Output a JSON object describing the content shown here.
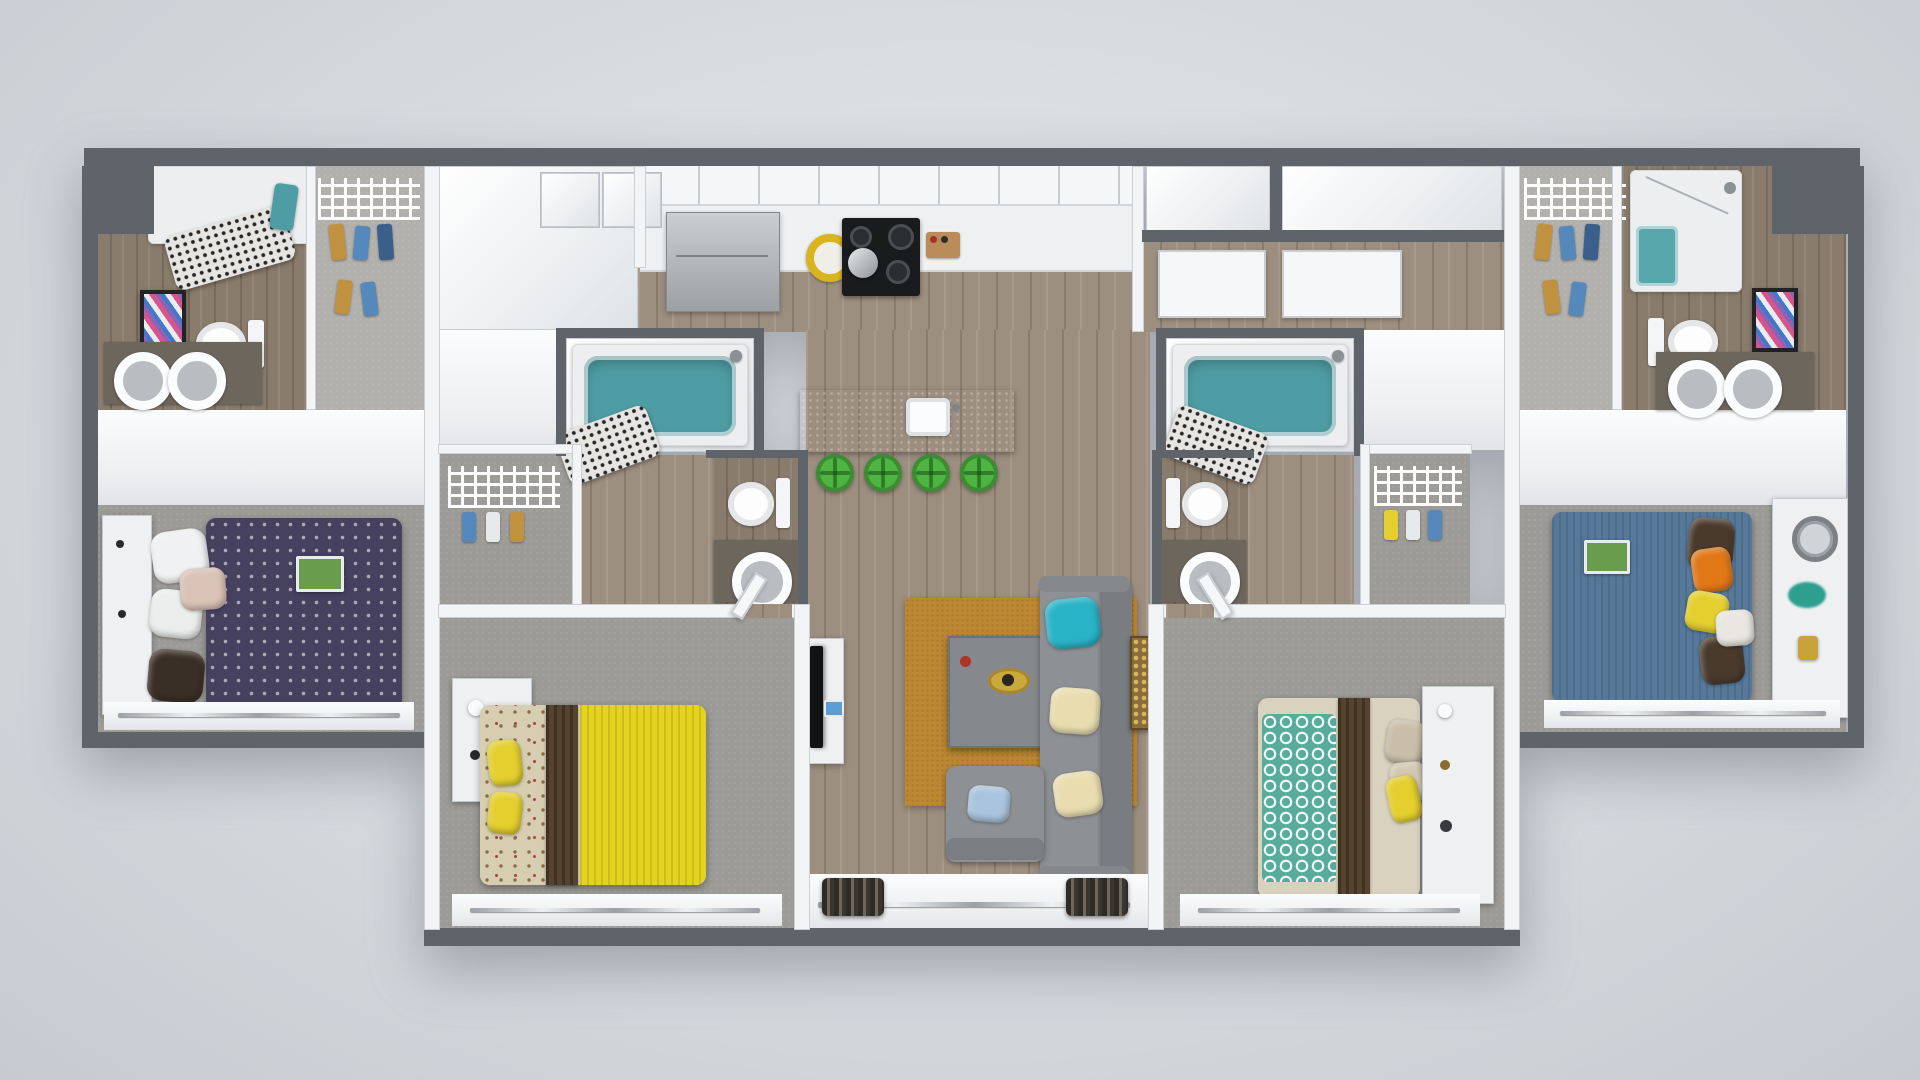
{
  "scene": {
    "type": "3d-floor-plan-render",
    "description": "Top-down 3D render of a symmetric 4-bedroom, 4-bathroom apartment with open kitchen, island with bar stools, and central living room with balcony doors",
    "background": "#d6dade",
    "bedroom_count": 4,
    "bathroom_count": 4,
    "bar_stool_count": 4
  },
  "palette": {
    "wall_dark": "#5f636a",
    "wall_light": "#f3f4f6",
    "wood_floor": "#9d8f80",
    "bath_floor": "#897c6d",
    "carpet": "#9c9b97",
    "tub_teal": "#4f9da4",
    "shower_teal": "#58a7ad",
    "stool_green": "#4eb442",
    "rug_gold": "#bd8834",
    "sofa_gray": "#8d9094",
    "pillow_teal": "#29b3c6",
    "pillow_cream": "#e9ddb0",
    "pillow_blue": "#aac4de",
    "pillow_orange": "#e07818",
    "pillow_yellow": "#e4cf2e",
    "pillow_brown": "#4a3a2c",
    "bed1_duvet": "#474160",
    "bed2_blanket": "#e5d41f",
    "bed3_quilt": "#57ab9c",
    "bed4_duvet": "#56799a",
    "runner_brown": "#55422f",
    "towel_teal": "#4f9da4",
    "clothes_tan": "#c0913f",
    "clothes_blue": "#5588bb",
    "clothes_navy": "#3a5f8a",
    "rug_trim": "#a8752c"
  },
  "rooms": [
    {
      "id": "bathroom-1",
      "label": "Bathroom 1",
      "floor": "wood",
      "items": [
        "shower with speckled curtain",
        "teal towel",
        "toilet",
        "framed art",
        "double-sink vanity"
      ]
    },
    {
      "id": "closet-1",
      "label": "Walk-in Closet 1",
      "floor": "carpet",
      "items": [
        "wire shelving",
        "hanging clothes"
      ]
    },
    {
      "id": "bedroom-1",
      "label": "Bedroom 1",
      "floor": "carpet",
      "items": [
        "bed with purple patterned duvet",
        "white pillows",
        "brown throw pillow",
        "headboard shelf",
        "magazine",
        "window with curtain rail"
      ]
    },
    {
      "id": "bedroom-2",
      "label": "Bedroom 2",
      "floor": "carpet",
      "items": [
        "bed with yellow blanket and floral sheets",
        "brown runner",
        "yellow pillows",
        "white dresser with lamp",
        "closet nook with wire shelf",
        "window with curtain rail"
      ]
    },
    {
      "id": "bathroom-2",
      "label": "Bathroom 2",
      "floor": "bath",
      "items": [
        "teal tub",
        "speckled shower curtain",
        "shower head",
        "toilet",
        "vanity sink"
      ]
    },
    {
      "id": "kitchen",
      "label": "Kitchen",
      "floor": "wood",
      "items": [
        "upper cabinets",
        "counter run",
        "stainless refrigerator",
        "black range with pot",
        "yellow bowl",
        "spice rack",
        "island with sink",
        "4 green bar stools"
      ]
    },
    {
      "id": "living-room",
      "label": "Living Room",
      "floor": "wood",
      "items": [
        "gray sofa",
        "teal pillow",
        "cream pillows",
        "gold rug",
        "coffee table with tray and candle",
        "armchair with light blue pillow",
        "tv console",
        "mosaic wall art",
        "balcony doors with curtains"
      ]
    },
    {
      "id": "bathroom-3",
      "label": "Bathroom 3",
      "floor": "bath",
      "items": [
        "teal tub",
        "speckled shower curtain",
        "shower head",
        "toilet",
        "vanity sink"
      ]
    },
    {
      "id": "bedroom-3",
      "label": "Bedroom 3",
      "floor": "carpet",
      "items": [
        "bed with teal trellis quilt",
        "brown runner",
        "yellow pillow",
        "tan pillows",
        "white headboard storage",
        "closet nook with wire shelf",
        "window with curtain rail"
      ]
    },
    {
      "id": "entry-hall",
      "label": "Entry Hall",
      "floor": "wood",
      "items": [
        "entry closets",
        "white doors"
      ]
    },
    {
      "id": "closet-4",
      "label": "Walk-in Closet 4",
      "floor": "carpet",
      "items": [
        "wire shelving",
        "hanging clothes"
      ]
    },
    {
      "id": "bathroom-4",
      "label": "Bathroom 4",
      "floor": "wood",
      "items": [
        "glass shower with teal floor",
        "toilet",
        "framed art",
        "double-sink vanity"
      ]
    },
    {
      "id": "bedroom-4",
      "label": "Bedroom 4",
      "floor": "carpet",
      "items": [
        "bed with blue duvet",
        "orange pillow",
        "yellow pillow",
        "white patterned pillow",
        "brown pillows",
        "magazine",
        "dresser with round mirror",
        "teal plant",
        "window with curtain rail"
      ]
    }
  ]
}
